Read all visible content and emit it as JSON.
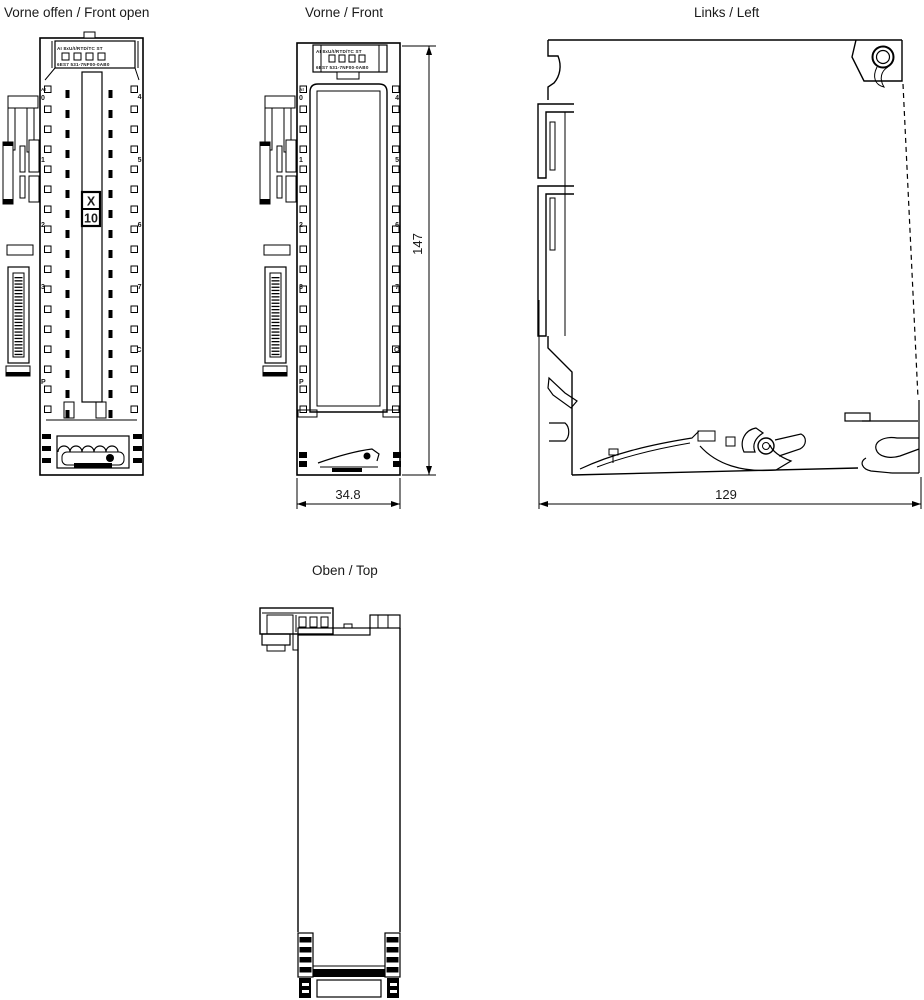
{
  "drawing": {
    "background": "#ffffff",
    "line_color": "#000000",
    "views": {
      "front_open": {
        "title": "Vorne offen / Front open"
      },
      "front": {
        "title": "Vorne / Front"
      },
      "left": {
        "title": "Links / Left"
      },
      "top": {
        "title": "Oben / Top"
      }
    },
    "module": {
      "label_line1": "AI 8xU/I/RTD/TC ST",
      "label_line2": "6ES7 531-7NF00-0AB0",
      "connector_x": "X",
      "connector_no": "10"
    },
    "terminals": {
      "group_label": "AI",
      "left": [
        "0",
        "1",
        "2",
        "3",
        "P"
      ],
      "right": [
        "4",
        "5",
        "6",
        "7",
        "C"
      ]
    },
    "dimensions": {
      "front_width_mm": "34.8",
      "front_height_mm": "147",
      "side_depth_mm": "129"
    }
  }
}
